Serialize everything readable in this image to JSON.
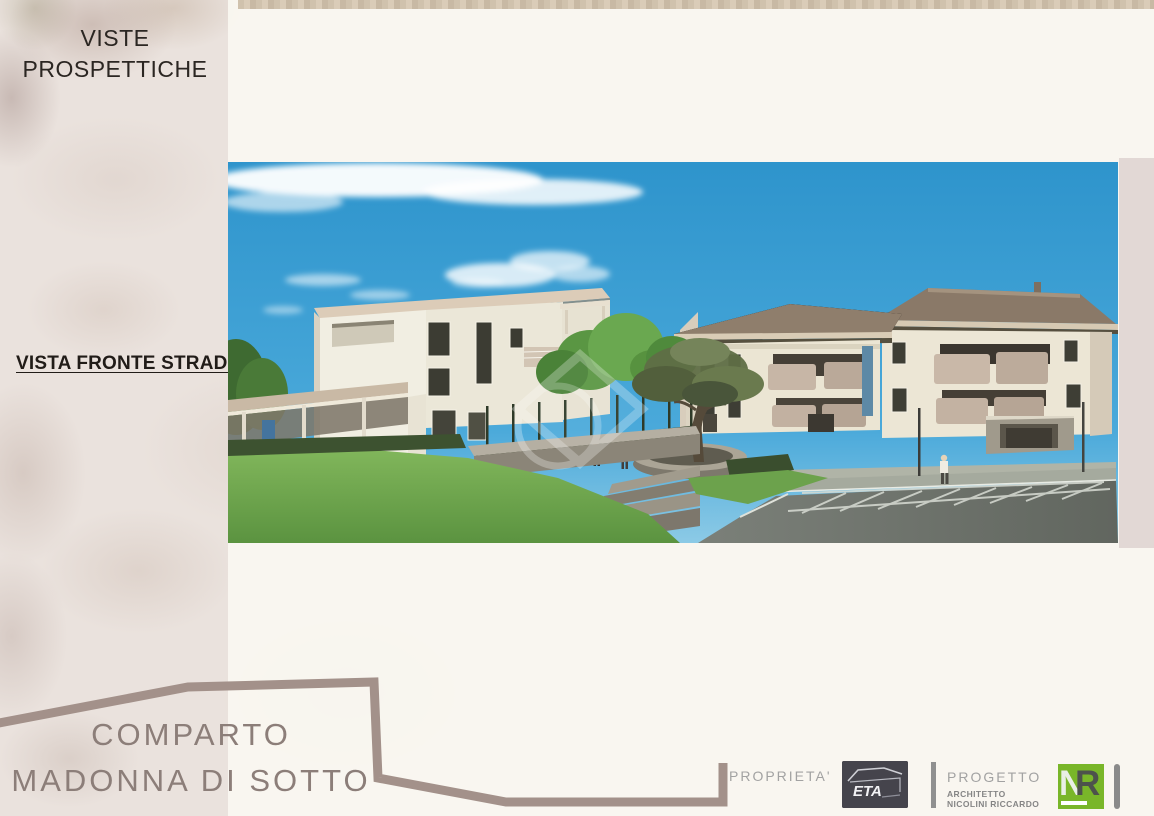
{
  "slide": {
    "header_title_line1": "VISTE",
    "header_title_line2": "PROSPETTICHE",
    "view_label": "VISTA FRONTE STRADA",
    "project_name_line1": "COMPARTO",
    "project_name_line2": "MADONNA DI SOTTO"
  },
  "footer": {
    "owner_label": "PROPRIETA'",
    "owner_logo_text": "ETA",
    "project_label": "PROGETTO",
    "architect_title": "ARCHITETTO",
    "architect_name": "NICOLINI RICCARDO",
    "designer_logo_n": "N",
    "designer_logo_r": "R"
  },
  "colors": {
    "slide_background": "#eae2dd",
    "panel_background": "#faf7f1",
    "outline_shape": "#a3918a",
    "header_text": "#2b2622",
    "project_title_text": "#8c7e79",
    "footer_text": "#a2a2a2",
    "nr_logo_green": "#79b629",
    "eta_logo_dark": "#45444c",
    "sky_blue": "#3b9fd4",
    "lawn_green": "#6ca64c",
    "roof_brown": "#8f7e6c"
  }
}
